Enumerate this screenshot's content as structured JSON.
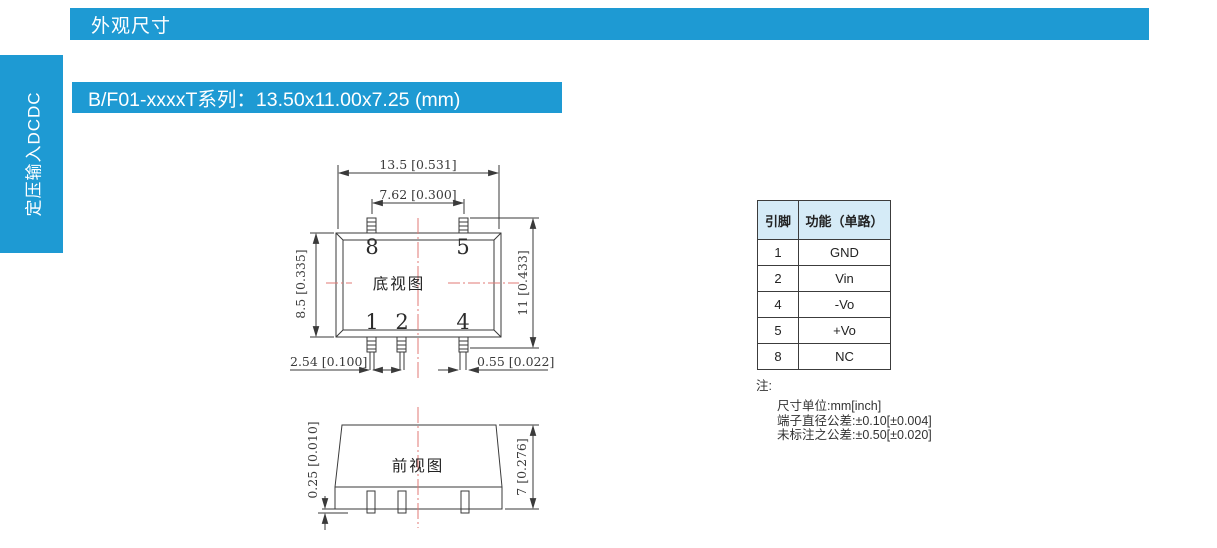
{
  "header": {
    "title": "外观尺寸"
  },
  "sidebar": {
    "label": "定压输入DCDC"
  },
  "section": {
    "title": "B/F01-xxxxT系列：13.50x11.00x7.25 (mm)"
  },
  "drawing": {
    "bottom_view": {
      "label": "底视图",
      "dims": {
        "overall_width": "13.5 [0.531]",
        "pin_span": "7.62 [0.300]",
        "body_height": "8.5 [0.335]",
        "total_height": "11 [0.433]",
        "pin_pitch": "2.54 [0.100]",
        "lead_width": "0.55 [0.022]"
      },
      "pin_labels": {
        "p8": "8",
        "p5": "5",
        "p1": "1",
        "p2": "2",
        "p4": "4"
      }
    },
    "front_view": {
      "label": "前视图",
      "dims": {
        "standoff": "0.25 [0.010]",
        "height": "7 [0.276]"
      }
    }
  },
  "pin_table": {
    "headers": [
      "引脚",
      "功能（单路）"
    ],
    "rows": [
      [
        "1",
        "GND"
      ],
      [
        "2",
        "Vin"
      ],
      [
        "4",
        "-Vo"
      ],
      [
        "5",
        "+Vo"
      ],
      [
        "8",
        "NC"
      ]
    ]
  },
  "notes": {
    "title": "注:",
    "lines": [
      "尺寸单位:mm[inch]",
      "端子直径公差:±0.10[±0.004]",
      "未标注之公差:±0.50[±0.020]"
    ]
  },
  "colors": {
    "accent_blue": "#1E9AD3",
    "table_header_bg": "#D5EBF7",
    "centerline_red": "#E07A76",
    "drawing_line": "#3A3A3A"
  }
}
